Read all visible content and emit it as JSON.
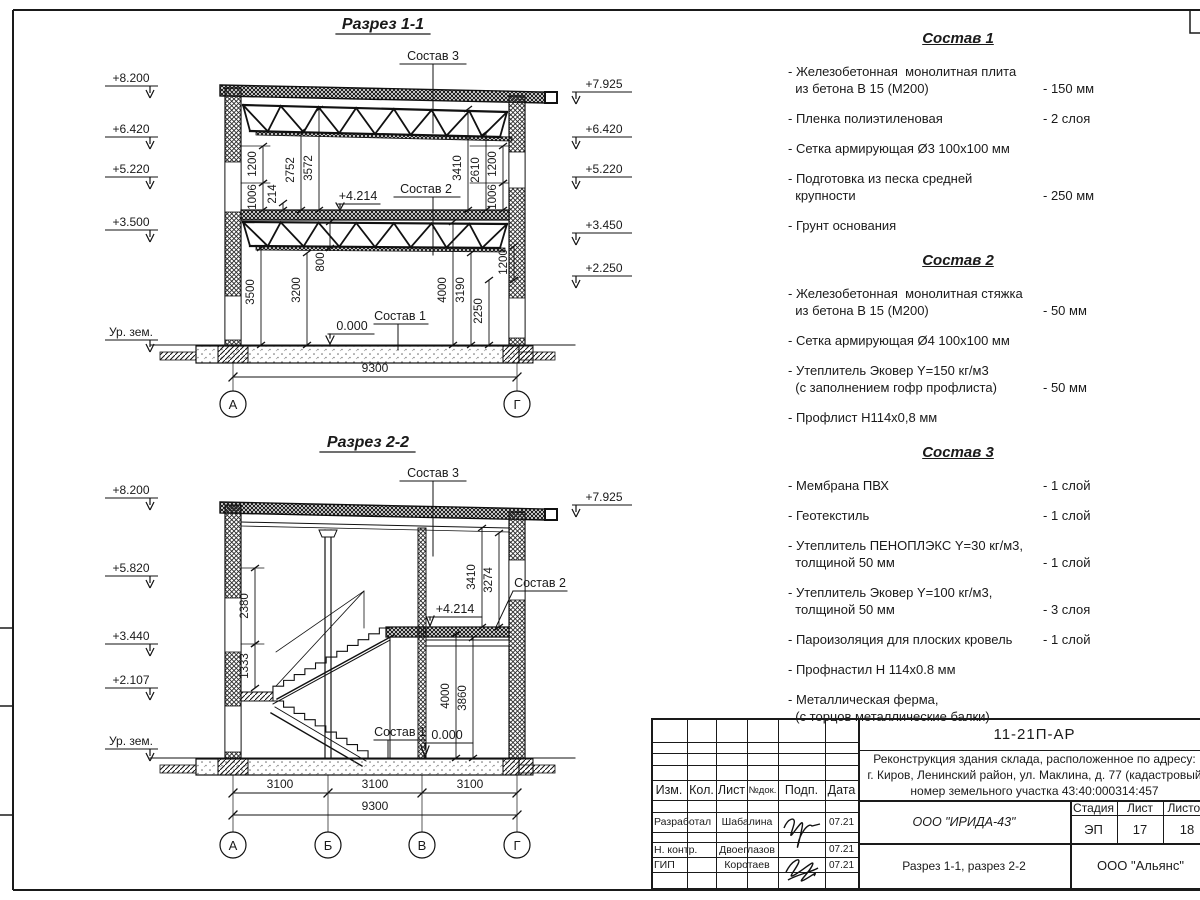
{
  "drawing": {
    "section1": {
      "title": "Разрез 1-1",
      "elev_left": [
        "+8.200",
        "+6.420",
        "+5.220",
        "+3.500",
        "Ур. зем."
      ],
      "elev_right": [
        "+7.925",
        "+6.420",
        "+5.220",
        "+3.450",
        "+2.250"
      ],
      "dims": [
        "1200",
        "1006",
        "214",
        "2752",
        "3572",
        "800",
        "3500",
        "3200",
        "3410",
        "2610",
        "1200",
        "1006",
        "4000",
        "3190",
        "2250",
        "1200"
      ],
      "total_dim": "9300",
      "grid": [
        "А",
        "Г"
      ],
      "callouts": {
        "c3": "Состав 3",
        "c2": "Состав 2",
        "c1": "Состав 1",
        "lvl_mid": "+4.214",
        "lvl_zero": "0.000"
      }
    },
    "section2": {
      "title": "Разрез 2-2",
      "elev_left": [
        "+8.200",
        "+5.820",
        "+3.440",
        "+2.107",
        "Ур. зем."
      ],
      "elev_right": [
        "+7.925"
      ],
      "dims": [
        "2380",
        "1333",
        "3410",
        "3274",
        "4000",
        "3860"
      ],
      "span_dims": [
        "3100",
        "3100",
        "3100"
      ],
      "total_dim": "9300",
      "grid": [
        "А",
        "Б",
        "В",
        "Г"
      ],
      "callouts": {
        "c3": "Состав 3",
        "c2": "Состав 2",
        "c1": "Состав 1",
        "lvl_mid": "+4.214",
        "lvl_zero": "0.000"
      }
    }
  },
  "compositions": [
    {
      "title": "Состав 1",
      "items": [
        {
          "name": "- Железобетонная  монолитная плита\n  из бетона В 15 (М200)",
          "value": "- 150 мм"
        },
        {
          "name": "- Пленка полиэтиленовая",
          "value": "-  2 слоя"
        },
        {
          "name": "- Сетка армирующая Ø3 100х100 мм",
          "value": ""
        },
        {
          "name": "- Подготовка из песка средней\n  крупности",
          "value": "- 250 мм"
        },
        {
          "name": "- Грунт основания",
          "value": ""
        }
      ]
    },
    {
      "title": "Состав 2",
      "items": [
        {
          "name": "- Железобетонная  монолитная стяжка\n  из бетона В 15 (М200)",
          "value": "- 50 мм"
        },
        {
          "name": "- Сетка армирующая Ø4 100х100 мм",
          "value": ""
        },
        {
          "name": "- Утеплитель Эковер Y=150 кг/м3\n  (с заполнением гофр профлиста)",
          "value": "- 50 мм"
        },
        {
          "name": "- Профлист Н114х0,8 мм",
          "value": ""
        }
      ]
    },
    {
      "title": "Состав 3",
      "items": [
        {
          "name": "- Мембрана ПВХ",
          "value": "- 1 слой"
        },
        {
          "name": "- Геотекстиль",
          "value": "- 1 слой"
        },
        {
          "name": "- Утеплитель ПЕНОПЛЭКС Y=30 кг/м3,\n  толщиной 50 мм",
          "value": "- 1 слой"
        },
        {
          "name": "- Утеплитель Эковер Y=100 кг/м3,\n  толщиной 50 мм",
          "value": "- 3 слоя"
        },
        {
          "name": "- Пароизоляция для плоских кровель",
          "value": "- 1 слой"
        },
        {
          "name": "- Профнастил Н 114х0.8 мм",
          "value": ""
        },
        {
          "name": "- Металлическая ферма,\n  (с торцов металлические балки)",
          "value": ""
        }
      ]
    }
  ],
  "titleblock": {
    "doc_code": "11-21П-АР",
    "project_lines": [
      "Реконструкция здания склада, расположенное по адресу:",
      "г. Киров, Ленинский район, ул. Маклина, д. 77 (кадастровый",
      "номер земельного участка 43:40:000314:457"
    ],
    "header_cols": [
      "Изм.",
      "Кол.",
      "Лист",
      "№док.",
      "Подп.",
      "Дата"
    ],
    "rows": [
      {
        "role": "Разработал",
        "name": "Шабалина",
        "date": "07.21"
      },
      {
        "role": "Н. контр.",
        "name": "Двоеглазов",
        "date": "07.21"
      },
      {
        "role": "ГИП",
        "name": "Коротаев",
        "date": "07.21"
      }
    ],
    "company": "ООО \"ИРИДА-43\"",
    "stage_label": "Стадия",
    "sheet_label": "Лист",
    "sheets_label": "Листов",
    "stage": "ЭП",
    "sheet": "17",
    "sheets": "18",
    "sheet_title": "Разрез 1-1, разрез 2-2",
    "contractor": "ООО \"Альянс\""
  }
}
